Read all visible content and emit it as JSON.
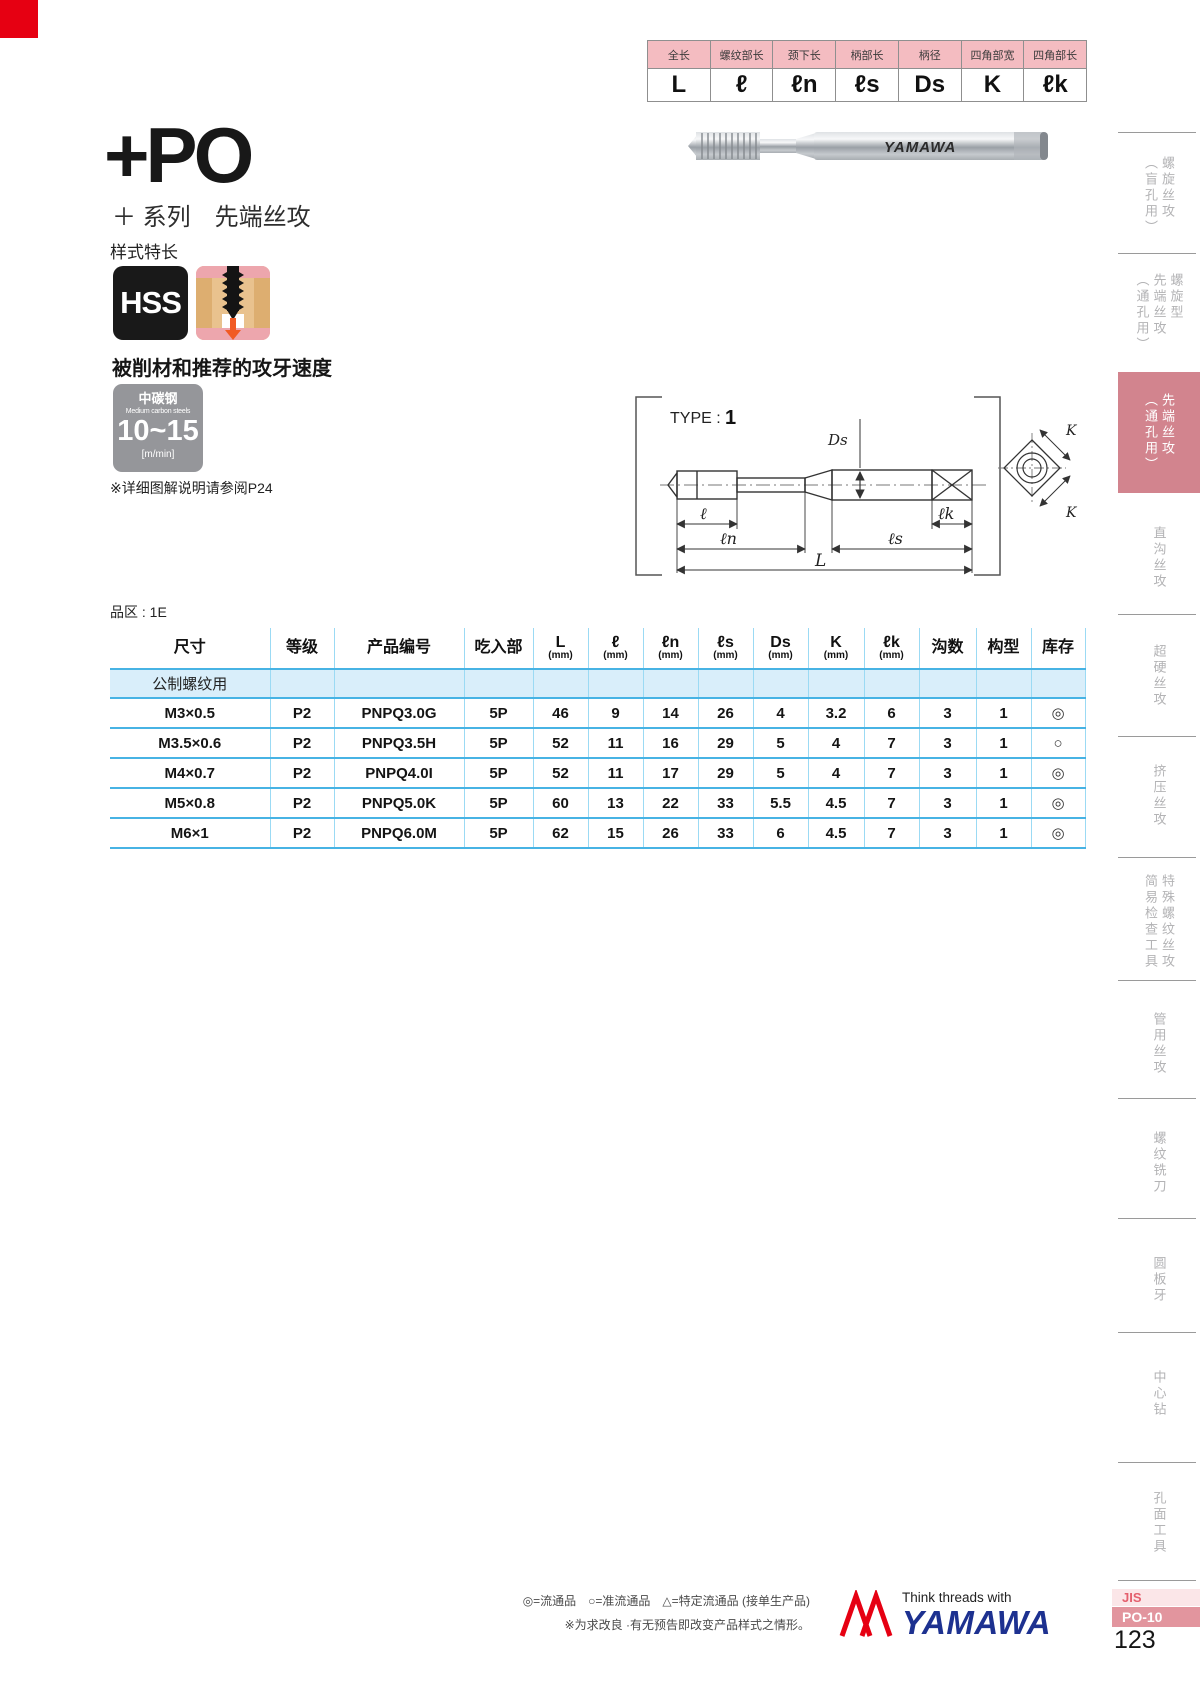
{
  "page": {
    "page_number": "123",
    "jis_label": "JIS",
    "page_code": "PO-10",
    "corner_color": "#e60012",
    "accent_pink": "#d2848e",
    "table_blue": "#47b3e4"
  },
  "spec_legend": {
    "columns": [
      {
        "label": "全长",
        "symbol": "L"
      },
      {
        "label": "螺纹部长",
        "symbol": "ℓ"
      },
      {
        "label": "颈下长",
        "symbol": "ℓn"
      },
      {
        "label": "柄部长",
        "symbol": "ℓs"
      },
      {
        "label": "柄径",
        "symbol": "Ds"
      },
      {
        "label": "四角部宽",
        "symbol": "K"
      },
      {
        "label": "四角部长",
        "symbol": "ℓk"
      }
    ]
  },
  "header": {
    "series_code": "+PO",
    "series_subtitle": "＋ 系列　先端丝攻",
    "features_label": "样式特长",
    "hss_badge": "HSS",
    "photo_brand": "YAMAWA"
  },
  "speed": {
    "heading": "被削材和推荐的攻牙速度",
    "material_cn": "中碳钢",
    "material_en": "Medium carbon steels",
    "range": "10~15",
    "unit": "[m/min]",
    "note": "※详细图解说明请参阅P24"
  },
  "diagram": {
    "type_label": "TYPE :",
    "type_value": "1",
    "dim_Ds": "Ds",
    "dim_ell": "ℓ",
    "dim_ell_n": "ℓn",
    "dim_ell_s": "ℓs",
    "dim_ell_k": "ℓk",
    "dim_L": "L",
    "dim_K": "K"
  },
  "table": {
    "zone_label": "品区 : 1E",
    "headers": [
      {
        "main": "尺寸",
        "sub": ""
      },
      {
        "main": "等级",
        "sub": ""
      },
      {
        "main": "产品编号",
        "sub": ""
      },
      {
        "main": "吃入部",
        "sub": ""
      },
      {
        "main": "L",
        "sub": "(mm)"
      },
      {
        "main": "ℓ",
        "sub": "(mm)"
      },
      {
        "main": "ℓn",
        "sub": "(mm)"
      },
      {
        "main": "ℓs",
        "sub": "(mm)"
      },
      {
        "main": "Ds",
        "sub": "(mm)"
      },
      {
        "main": "K",
        "sub": "(mm)"
      },
      {
        "main": "ℓk",
        "sub": "(mm)"
      },
      {
        "main": "沟数",
        "sub": ""
      },
      {
        "main": "构型",
        "sub": ""
      },
      {
        "main": "库存",
        "sub": ""
      }
    ],
    "subheader": "公制螺纹用",
    "rows": [
      [
        "M3×0.5",
        "P2",
        "PNPQ3.0G",
        "5P",
        "46",
        "9",
        "14",
        "26",
        "4",
        "3.2",
        "6",
        "3",
        "1",
        "◎"
      ],
      [
        "M3.5×0.6",
        "P2",
        "PNPQ3.5H",
        "5P",
        "52",
        "11",
        "16",
        "29",
        "5",
        "4",
        "7",
        "3",
        "1",
        "○"
      ],
      [
        "M4×0.7",
        "P2",
        "PNPQ4.0I",
        "5P",
        "52",
        "11",
        "17",
        "29",
        "5",
        "4",
        "7",
        "3",
        "1",
        "◎"
      ],
      [
        "M5×0.8",
        "P2",
        "PNPQ5.0K",
        "5P",
        "60",
        "13",
        "22",
        "33",
        "5.5",
        "4.5",
        "7",
        "3",
        "1",
        "◎"
      ],
      [
        "M6×1",
        "P2",
        "PNPQ6.0M",
        "5P",
        "62",
        "15",
        "26",
        "33",
        "6",
        "4.5",
        "7",
        "3",
        "1",
        "◎"
      ]
    ]
  },
  "sidebar": {
    "tabs": [
      {
        "label": "螺旋丝攻\n（盲孔用）",
        "active": false
      },
      {
        "label": "螺旋型\n先端丝攻\n（通孔用）",
        "active": false
      },
      {
        "label": "先端丝攻\n（通孔用）",
        "active": true
      },
      {
        "label": "直沟丝攻",
        "active": false
      },
      {
        "label": "超硬丝攻",
        "active": false
      },
      {
        "label": "挤压丝攻",
        "active": false
      },
      {
        "label": "特殊螺纹丝攻\n简易检查工具",
        "active": false
      },
      {
        "label": "管用丝攻",
        "active": false
      },
      {
        "label": "螺纹铣刀",
        "active": false
      },
      {
        "label": "圆板牙",
        "active": false
      },
      {
        "label": "中心钻",
        "active": false
      },
      {
        "label": "孔面工具",
        "active": false
      }
    ]
  },
  "footer": {
    "legend": "◎=流通品　○=准流通品　△=特定流通品 (接单生产品)",
    "note": "※为求改良 ·有无预告即改变产品样式之情形。",
    "logo_tagline": "Think threads with",
    "logo_text": "YAMAWA"
  }
}
